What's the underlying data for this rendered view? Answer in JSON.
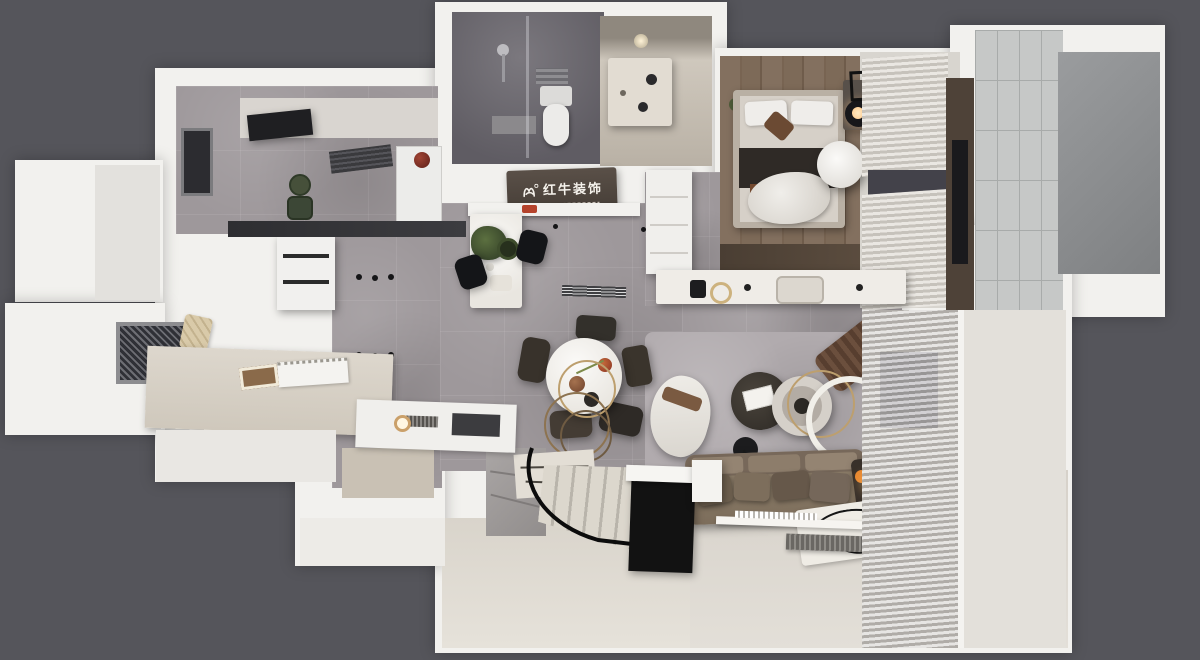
{
  "logo": {
    "text": "红牛装饰",
    "icon": "bull-icon"
  },
  "colors": {
    "background": "#55555b",
    "wall": "#f2f1ee",
    "wall_shade": "#e3e1dd",
    "floor_marble": "#9e989b",
    "floor_marble_light": "#b3adaf",
    "floor_wood": "#7d6c5c",
    "floor_beige": "#ddd8d0",
    "bath_dark": "#6a676d",
    "tile": "#c6c8c7",
    "curtain_light": "#eae7e2",
    "curtain_shade": "#c6c2bb",
    "sofa": "#82735f",
    "cushion_dark": "#5f5243",
    "wood_dark": "#4e4238",
    "sign_bg": "#4c433a",
    "sign_text": "#f5f2ec",
    "gold": "#bd9f6e",
    "black": "#17171a",
    "accent_warm": "#e8872f"
  }
}
